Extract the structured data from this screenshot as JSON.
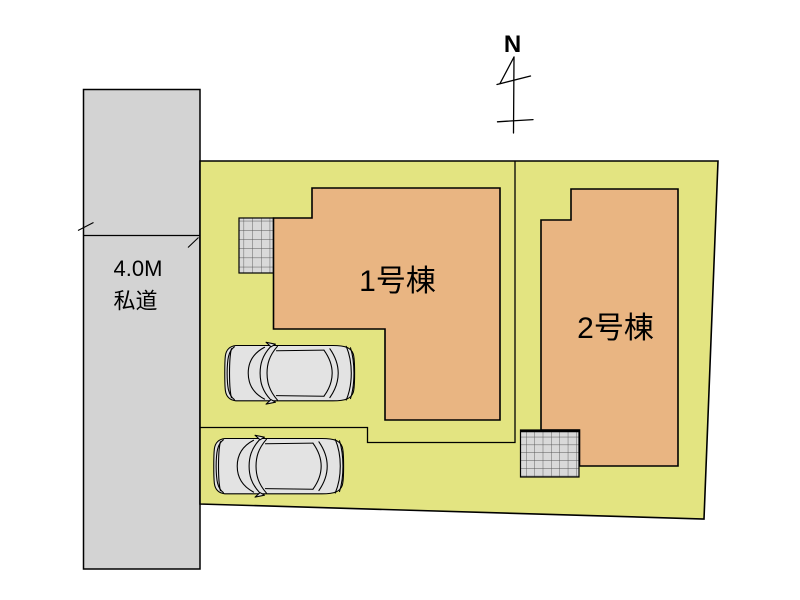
{
  "north": {
    "label": "N"
  },
  "road": {
    "width_label": "4.0M",
    "type_label": "私道",
    "fill": "#d3d3d3"
  },
  "plot": {
    "fill": "#e3e481"
  },
  "buildings": [
    {
      "label": "1号棟",
      "fill": "#e9b582"
    },
    {
      "label": "2号棟",
      "fill": "#e9b582"
    }
  ],
  "cars": [
    {
      "name": "car-1",
      "fill": "#e3e3e3"
    },
    {
      "name": "car-2",
      "fill": "#e3e3e3"
    }
  ],
  "hatch": {
    "fill": "#d9d9d9",
    "line": "#555555"
  },
  "line_color": "#000000"
}
